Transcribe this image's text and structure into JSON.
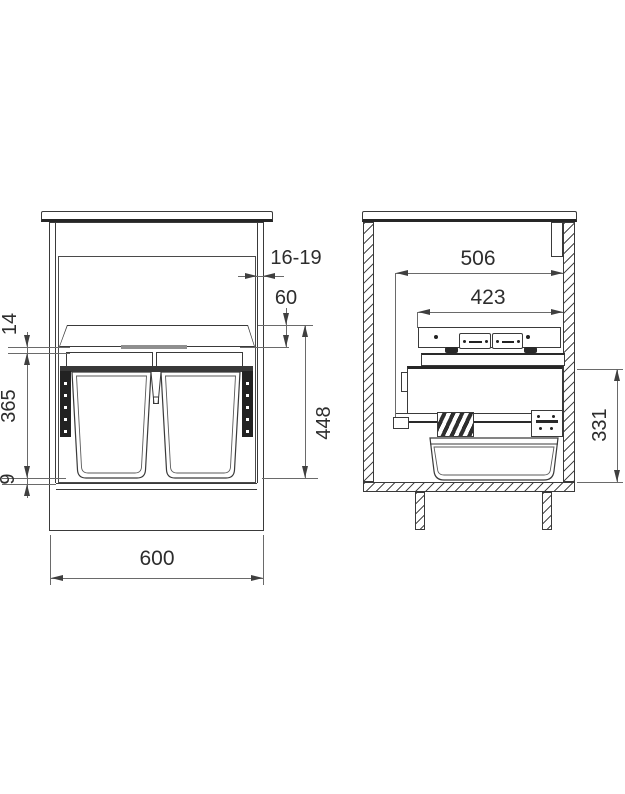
{
  "views": {
    "front": {
      "dims": {
        "door_thickness": "16-19",
        "frame_height": "60",
        "top_clearance": "14",
        "bin_height": "365",
        "bottom_clearance": "9",
        "required_height": "448",
        "cabinet_width": "600"
      }
    },
    "side": {
      "dims": {
        "pullout_depth": "506",
        "rail_length": "423",
        "required_side_height": "331"
      }
    }
  },
  "colors": {
    "outline": "#3a3a3a",
    "dim_line": "#6a6a6a",
    "dark_fill": "#222222",
    "text": "#2d2d2d",
    "background": "#ffffff"
  }
}
